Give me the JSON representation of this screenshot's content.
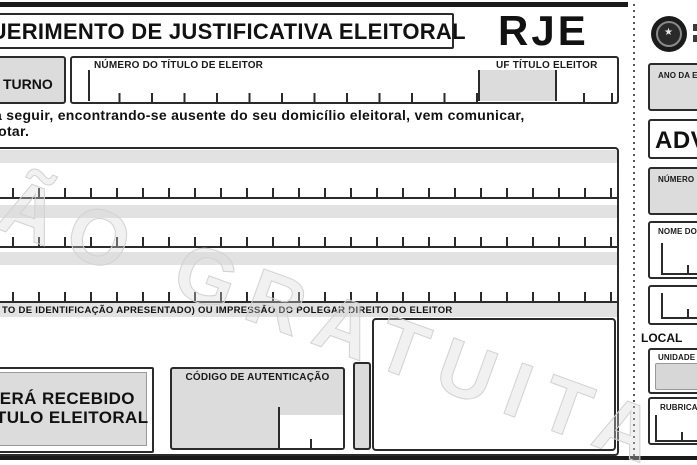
{
  "form": {
    "title": "REQUERIMENTO DE JUSTIFICATIVA ELEITORAL",
    "code": "RJE",
    "turno_label": "º TURNO",
    "numero_titulo_label": "NÚMERO DO TÍTULO DE ELEITOR",
    "uf_titulo_label": "UF TÍTULO ELEITOR",
    "paragraph_line1": "a seguir, encontrando-se ausente do seu domicílio eleitoral, vem comunicar,",
    "paragraph_line2": "votar.",
    "id_strip_label": "TO DE IDENTIFICAÇÃO APRESENTADO) OU IMPRESSÃO DO POLEGAR DIREITO DO ELEITOR",
    "recebido_line1": "SERÁ RECEBIDO",
    "recebido_line2": "TÍTULO ELEITORAL",
    "codigo_label": "CÓDIGO DE AUTENTICAÇÃO",
    "watermark": "ÇÃO GRATUITA"
  },
  "stub": {
    "ano_label": "ANO DA ELEIÇÃO",
    "advertencia": "ADVERTÊNCIA",
    "numero_label": "NÚMERO DO TÍTULO DE ELEITOR",
    "nome_label": "NOME DO ELEITOR",
    "local_label": "LOCAL",
    "uf_label": "UNIDADE DA FEDERAÇÃO",
    "rubrica_label": "RUBRICA DO SERVIDOR"
  },
  "colors": {
    "field_fill": "#dcdcdc",
    "strip_fill": "#e2e2e2",
    "line": "#2b2b2b",
    "watermark": "#d2d2d2"
  }
}
